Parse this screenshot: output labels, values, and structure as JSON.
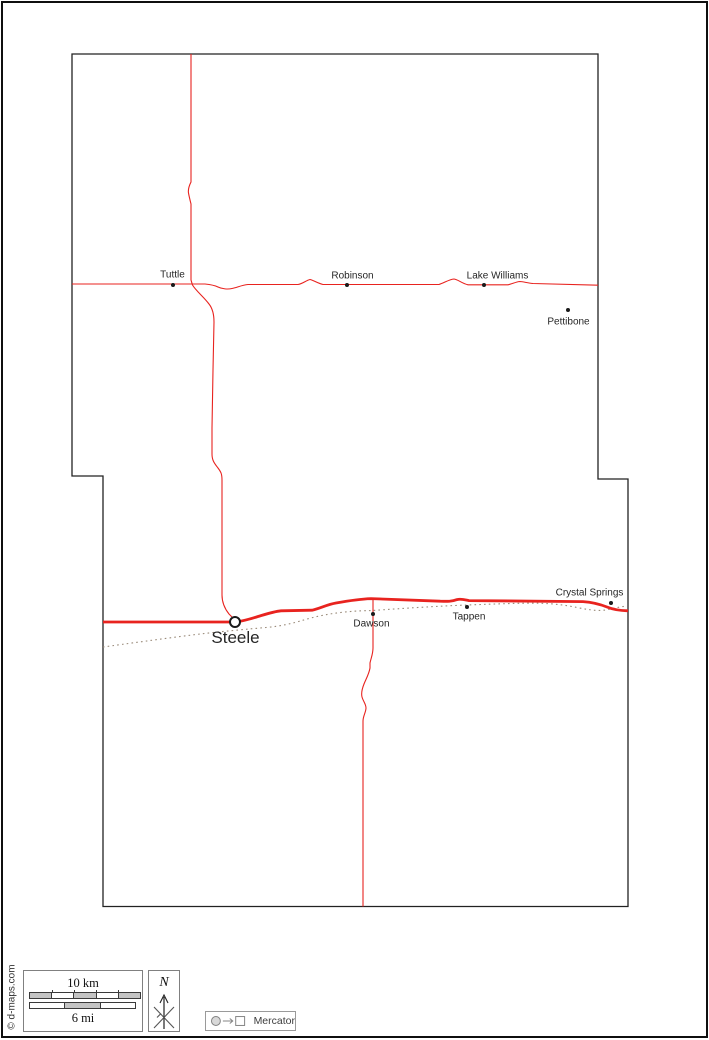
{
  "credit": "© d-maps.com",
  "colors": {
    "road_red": "#e8231f",
    "railroad": "#9a8b7a",
    "county_border": "#222222",
    "scale_fill": "#c4c4c4"
  },
  "map": {
    "towns": [
      {
        "name": "Tuttle",
        "x": 173,
        "y": 284.5,
        "marker": "dot",
        "label_x": 172.5,
        "label_y": 275,
        "font_size": 10
      },
      {
        "name": "Robinson",
        "x": 347,
        "y": 285,
        "marker": "dot",
        "label_x": 352.5,
        "label_y": 276,
        "font_size": 10
      },
      {
        "name": "Lake Williams",
        "x": 484,
        "y": 285,
        "marker": "dot",
        "label_x": 497.5,
        "label_y": 276,
        "font_size": 10
      },
      {
        "name": "Pettibone",
        "x": 568,
        "y": 310,
        "marker": "dot",
        "label_x": 568.5,
        "label_y": 322,
        "font_size": 10
      },
      {
        "name": "Steele",
        "x": 235,
        "y": 622,
        "marker": "seat",
        "label_x": 235.5,
        "label_y": 637.5,
        "font_size": 17
      },
      {
        "name": "Dawson",
        "x": 373,
        "y": 614,
        "marker": "dot",
        "label_x": 371.5,
        "label_y": 624,
        "font_size": 10
      },
      {
        "name": "Tappen",
        "x": 467,
        "y": 607,
        "marker": "dot",
        "label_x": 469,
        "label_y": 617,
        "font_size": 10
      },
      {
        "name": "Crystal Springs",
        "x": 611,
        "y": 603,
        "marker": "dot",
        "label_x": 589.5,
        "label_y": 593,
        "font_size": 10
      }
    ]
  },
  "legend": {
    "scale": {
      "km_label": "10 km",
      "mi_label": "6 mi",
      "km_segments": 5,
      "mi_segments": 3
    },
    "north": {
      "label": "N"
    },
    "projection": {
      "label": "Mercator"
    }
  }
}
